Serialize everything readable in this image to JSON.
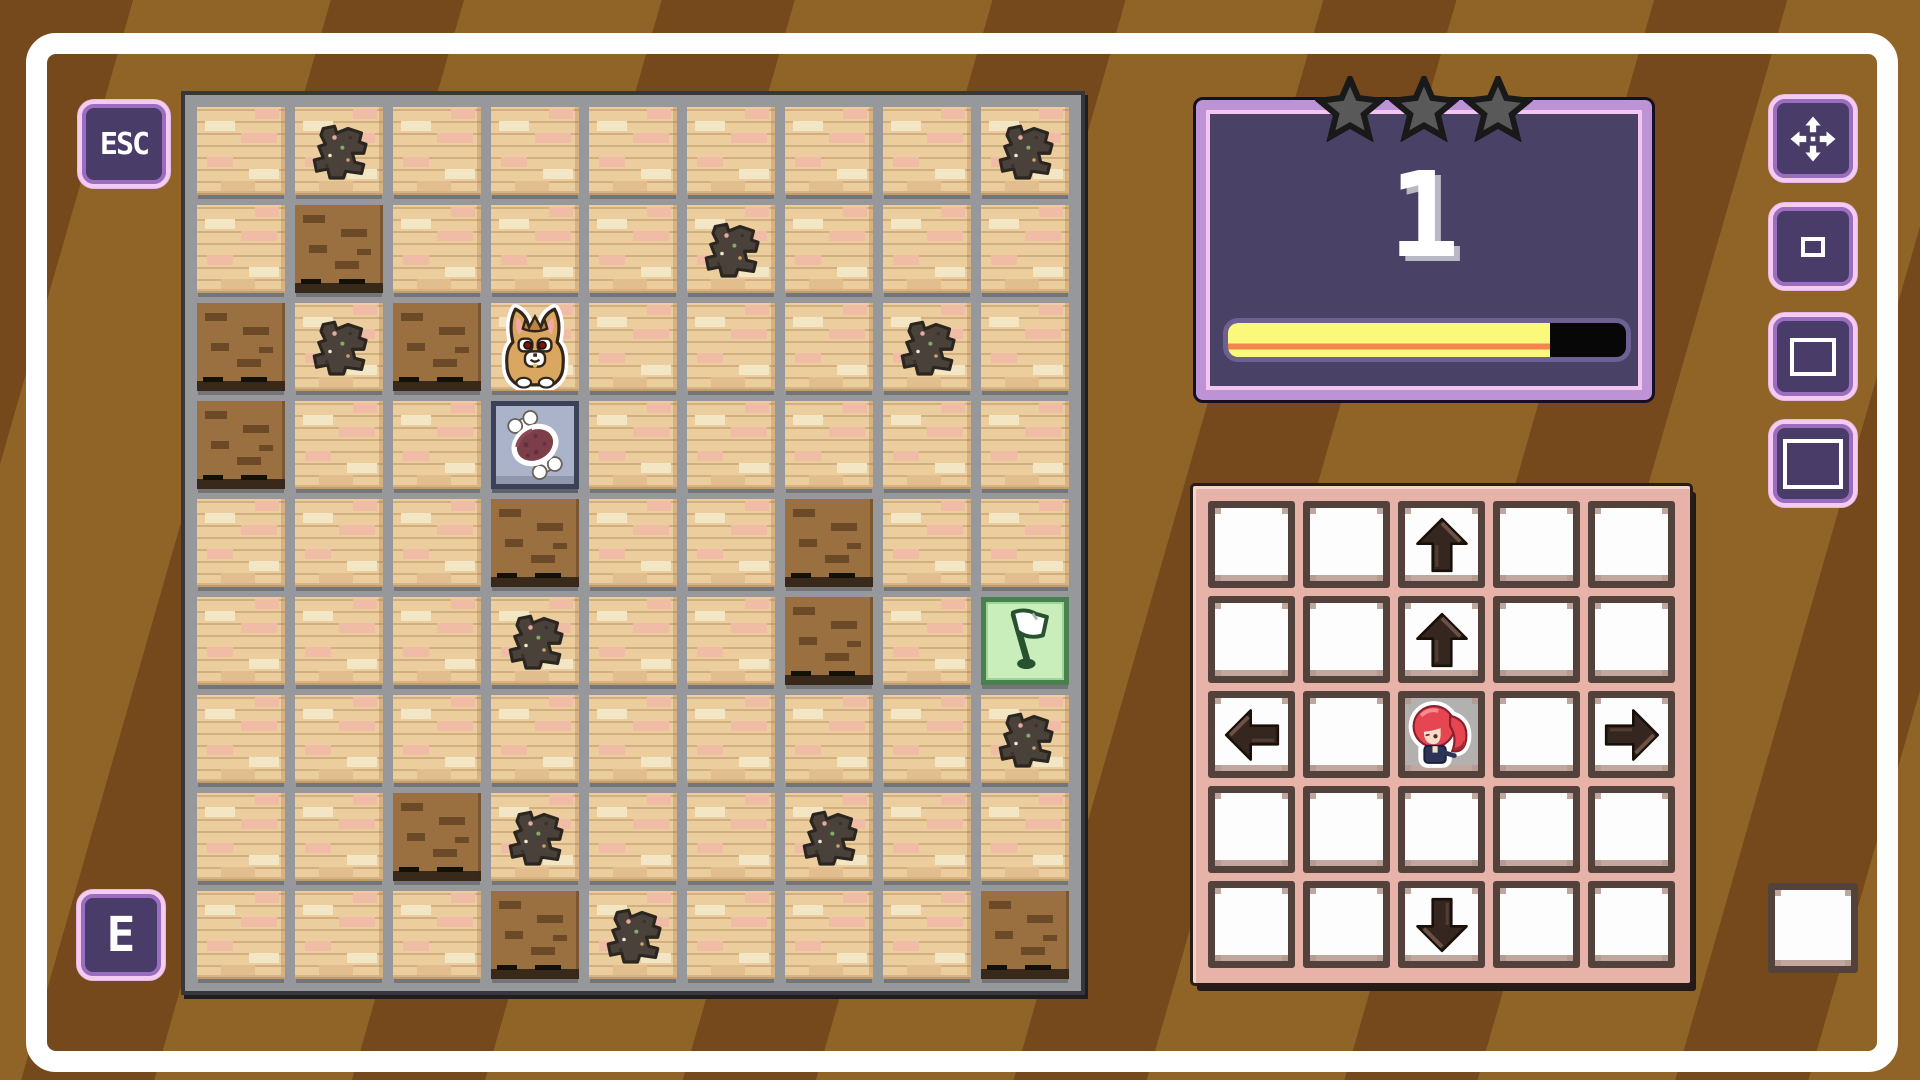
{
  "hud": {
    "esc_button_label": "ESC",
    "interact_button_label": "E"
  },
  "level_panel": {
    "level_number": "1",
    "stars": {
      "total": 3,
      "earned": 0
    },
    "progress": {
      "percent": 81,
      "fill_color": "#fbf97b",
      "accent_color": "#f5854f",
      "empty_color": "#070707"
    }
  },
  "side_buttons": [
    {
      "id": "move-tool",
      "icon": "move-arrows-icon"
    },
    {
      "id": "view-small",
      "icon": "square-small-icon"
    },
    {
      "id": "view-medium",
      "icon": "square-medium-icon"
    },
    {
      "id": "view-large",
      "icon": "square-large-icon"
    }
  ],
  "board": {
    "rows": 9,
    "cols": 9,
    "legend": {
      "L": "brick-floor",
      "D": "dirt-floor",
      "S": "dirt-splat",
      "P": "player-fox",
      "M": "meat-item",
      "F": "goal-flag"
    },
    "tiles": [
      [
        "L",
        "S",
        "L",
        "L",
        "L",
        "L",
        "L",
        "L",
        "S"
      ],
      [
        "L",
        "D",
        "L",
        "L",
        "L",
        "S",
        "L",
        "L",
        "L"
      ],
      [
        "D",
        "S",
        "D",
        "P",
        "L",
        "L",
        "L",
        "S",
        "L"
      ],
      [
        "D",
        "L",
        "L",
        "M",
        "L",
        "L",
        "L",
        "L",
        "L"
      ],
      [
        "L",
        "L",
        "L",
        "D",
        "L",
        "L",
        "D",
        "L",
        "L"
      ],
      [
        "L",
        "L",
        "L",
        "S",
        "L",
        "L",
        "D",
        "L",
        "F"
      ],
      [
        "L",
        "L",
        "L",
        "L",
        "L",
        "L",
        "L",
        "L",
        "S"
      ],
      [
        "L",
        "L",
        "D",
        "S",
        "L",
        "L",
        "S",
        "L",
        "L"
      ],
      [
        "L",
        "L",
        "L",
        "D",
        "S",
        "L",
        "L",
        "L",
        "D"
      ]
    ]
  },
  "control_pad": {
    "rows": 5,
    "cols": 5,
    "cells": [
      [
        "",
        "",
        "up",
        "",
        ""
      ],
      [
        "",
        "",
        "up",
        "",
        ""
      ],
      [
        "left",
        "",
        "character",
        "",
        "right"
      ],
      [
        "",
        "",
        "",
        "",
        ""
      ],
      [
        "",
        "",
        "down",
        "",
        ""
      ]
    ]
  },
  "spare_slot": {
    "present": true
  },
  "colors": {
    "background_brown": "#8f6426",
    "stripe_brown": "#75491c",
    "frame_white": "#ffffff",
    "button_purple": "#4a3c68",
    "button_border_pink": "#f4ccf2",
    "panel_purple": "#4a4167",
    "panel_border_lavender": "#bd93d6",
    "star_gray": "#595959",
    "board_gray": "#96989b",
    "pad_pink": "#e7b3a9",
    "tile_light": "#eccd9e",
    "tile_dirt": "#9b7040",
    "meat_tile_blue": "#aab3c9",
    "flag_tile_green": "#c9eebb"
  }
}
